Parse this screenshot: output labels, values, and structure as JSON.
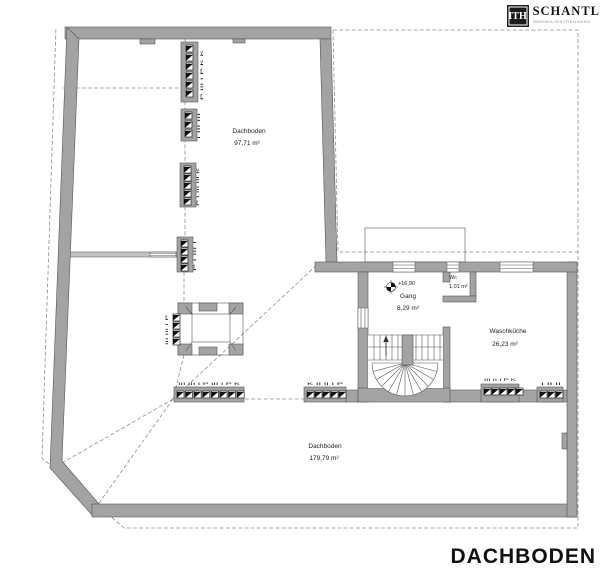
{
  "logo": {
    "mark": "ITH",
    "name": "SCHANTL",
    "subtitle": "IMMOBILIENTREUHAND"
  },
  "title": "DACHBODEN",
  "rooms": {
    "attic_upper": {
      "name": "Dachboden",
      "area": "97,71 m²"
    },
    "gang": {
      "name": "Gang",
      "area": "8,29 m²"
    },
    "wc": {
      "name": "Wc",
      "area": "1,01 m²"
    },
    "waschkueche": {
      "name": "Waschküche",
      "area": "26,23 m²"
    },
    "attic_lower": {
      "name": "Dachboden",
      "area": "179,79 m²"
    }
  },
  "level_marker": {
    "value": "+16,90"
  },
  "chimneys": {
    "top_vertical": {
      "labels": "P III I P K K"
    },
    "mid_vertical_1": {
      "labels": "I III III"
    },
    "mid_vertical_2": {
      "labels": "P I III III K"
    },
    "junction_vertical": {
      "labels": "P I III I"
    },
    "shaft_left": {
      "labels": "III III I P"
    },
    "bottom_row_left": {
      "labels": "III III I P III I P K"
    },
    "bottom_row_mid": {
      "labels": "K II II I P"
    },
    "basin_row_left": {
      "labels": "III II I P K"
    },
    "basin_row_right": {
      "labels": "I II II"
    }
  },
  "colors": {
    "wall": "#a3a3a3",
    "dash": "#8f8f8f",
    "ink": "#1d1d1d"
  }
}
